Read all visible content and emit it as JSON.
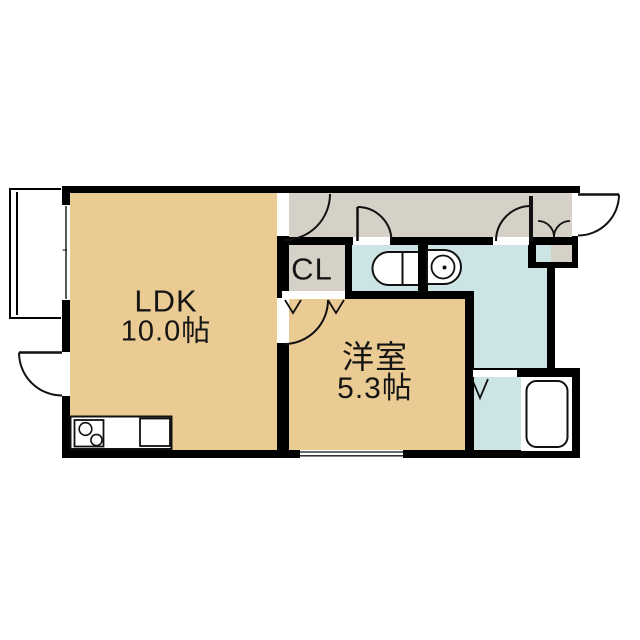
{
  "title": "1LDK間取り図",
  "colors": {
    "room_tan": "#EBCB94",
    "hall_gray": "#D5D1C6",
    "wet_blue": "#CDE4E4",
    "wall": "#000000",
    "background": "#FFFFFF"
  },
  "rooms": {
    "ldk": {
      "name": "LDK",
      "size": "10.0帖"
    },
    "western_room": {
      "name": "洋室",
      "size": "5.3帖"
    },
    "closet": {
      "label": "CL"
    }
  },
  "icons": [
    "toilet-icon",
    "washbasin-icon",
    "bathtub-icon",
    "stove-icon",
    "kitchen-sink-icon",
    "door-swing-arc-icon",
    "folding-door-icon",
    "window-icon",
    "balcony-icon"
  ]
}
